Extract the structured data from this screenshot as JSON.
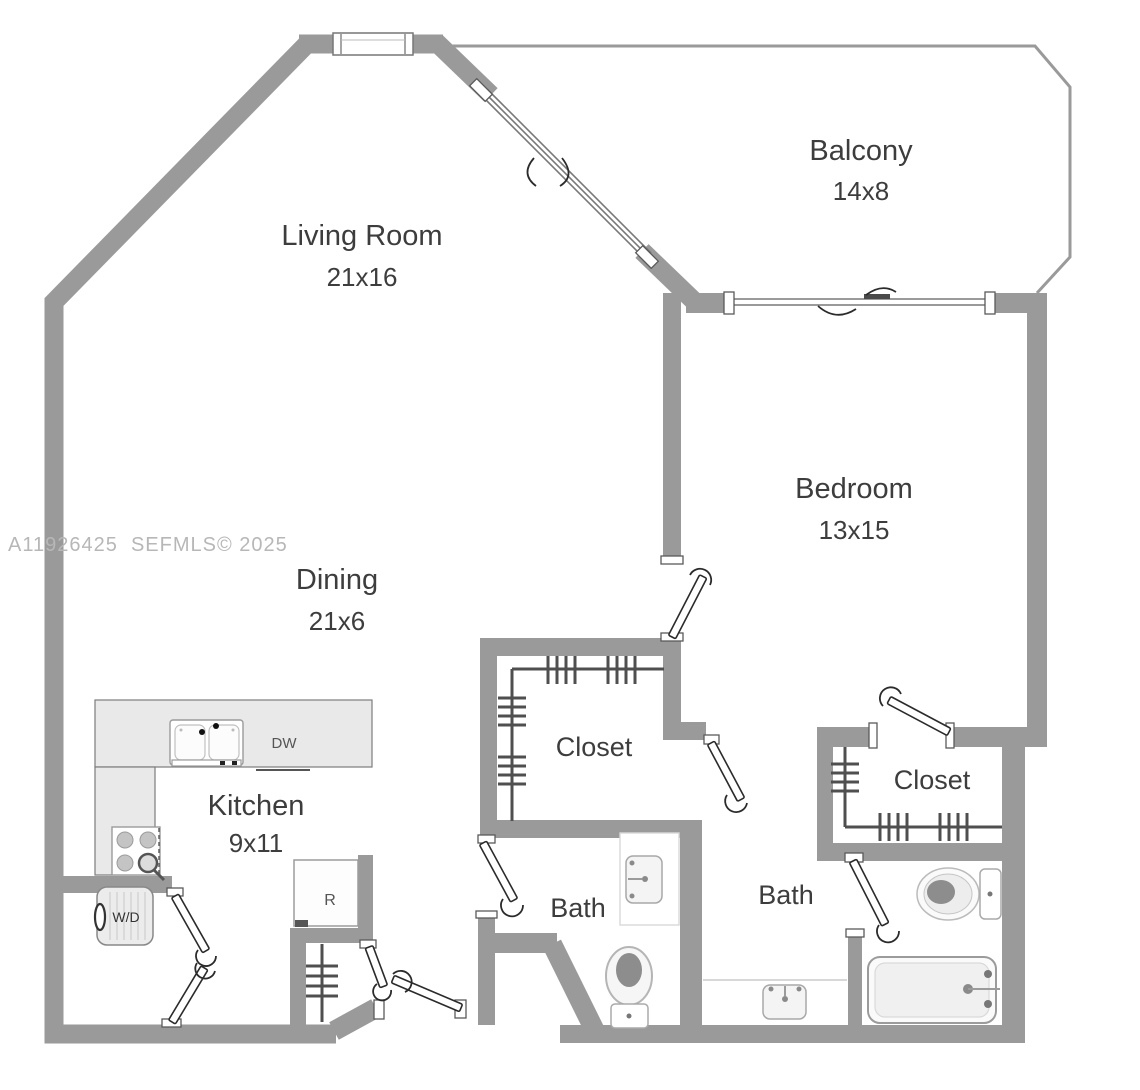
{
  "watermark": "A11926425  SEFMLS© 2025",
  "rooms": {
    "living_room": {
      "label": "Living Room",
      "dims": "21x16"
    },
    "balcony": {
      "label": "Balcony",
      "dims": "14x8"
    },
    "bedroom": {
      "label": "Bedroom",
      "dims": "13x15"
    },
    "dining": {
      "label": "Dining",
      "dims": "21x6"
    },
    "kitchen": {
      "label": "Kitchen",
      "dims": "9x11"
    },
    "closet_hall": {
      "label": "Closet"
    },
    "closet_bedroom": {
      "label": "Closet"
    },
    "bath_hall": {
      "label": "Bath"
    },
    "bath_bedroom": {
      "label": "Bath"
    }
  },
  "appliances": {
    "dishwasher": "DW",
    "washer_dryer": "W/D",
    "refrigerator": "R"
  },
  "colors": {
    "wall": "#9a9a9a",
    "counter_fill": "#e9e9e9",
    "label_text": "#3d3d3d",
    "watermark_text": "#b7b7b7"
  }
}
